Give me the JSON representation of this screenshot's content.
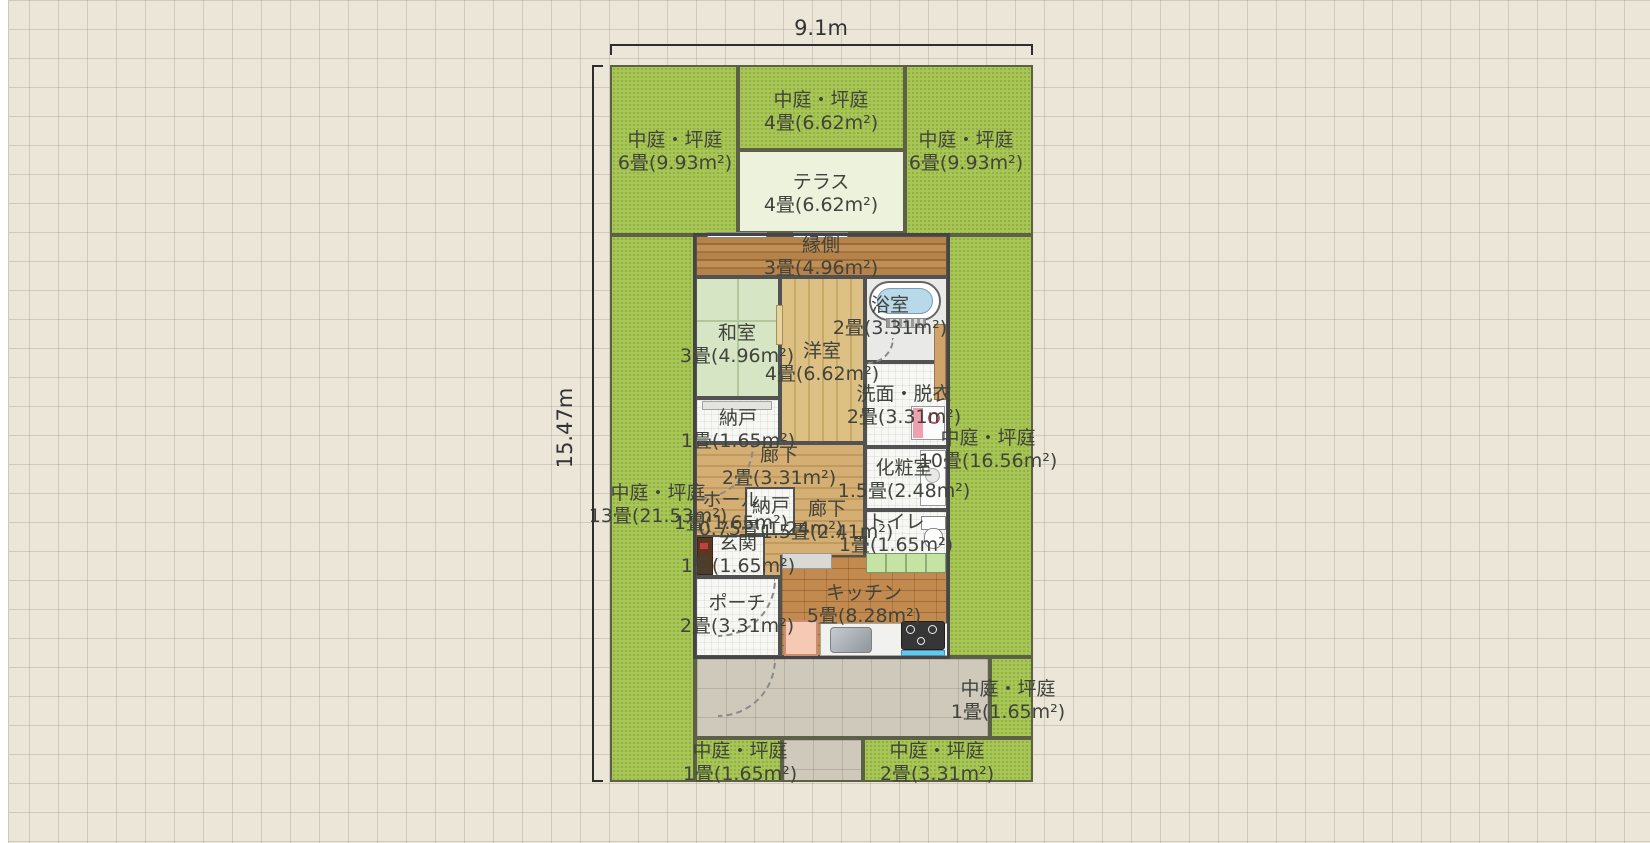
{
  "dimensions": {
    "width": "9.1m",
    "height": "15.47m"
  },
  "areas": {
    "g_top_left": {
      "name": "中庭・坪庭",
      "size": "6畳(9.93m²)"
    },
    "g_top_mid": {
      "name": "中庭・坪庭",
      "size": "4畳(6.62m²)"
    },
    "terrace": {
      "name": "テラス",
      "size": "4畳(6.62m²)"
    },
    "g_top_right": {
      "name": "中庭・坪庭",
      "size": "6畳(9.93m²)"
    },
    "g_left": {
      "name": "中庭・坪庭",
      "size": "13畳(21.53m²)"
    },
    "g_right": {
      "name": "中庭・坪庭",
      "size": "10畳(16.56m²)"
    },
    "g_right_small": {
      "name": "中庭・坪庭",
      "size": "1畳(1.65m²)"
    },
    "g_bottom_left": {
      "name": "中庭・坪庭",
      "size": "1畳(1.65m²)"
    },
    "g_bottom_right": {
      "name": "中庭・坪庭",
      "size": "2畳(3.31m²)"
    },
    "engawa": {
      "name": "縁側",
      "size": "3畳(4.96m²)"
    },
    "washitsu": {
      "name": "和室",
      "size": "3畳(4.96m²)"
    },
    "youshitsu": {
      "name": "洋室",
      "size": "4畳(6.62m²)"
    },
    "bathroom": {
      "name": "浴室",
      "size": "2畳(3.31m²)"
    },
    "senmen": {
      "name": "洗面・脱衣",
      "size": "2畳(3.31m²)"
    },
    "nando1": {
      "name": "納戸",
      "size": "1畳(1.65m²)"
    },
    "rouka1": {
      "name": "廊下",
      "size": "2畳(3.31m²)"
    },
    "keshoushitsu": {
      "name": "化粧室",
      "size": "1.5畳(2.48m²)"
    },
    "hall": {
      "name": "ホール",
      "size": "1畳(1.65m²)"
    },
    "nando2": {
      "name": "納戸",
      "size": "0.75畳(1.24m²)"
    },
    "rouka2": {
      "name": "廊下",
      "size": "1.5畳(2.41m²)"
    },
    "genkan": {
      "name": "玄関",
      "size": "1畳(1.65m²)"
    },
    "toilet": {
      "name": "トイレ",
      "size": "1畳(1.65m²)"
    },
    "porch": {
      "name": "ポーチ",
      "size": "2畳(3.31m²)"
    },
    "kitchen": {
      "name": "キッチン",
      "size": "5畳(8.28m²)"
    }
  }
}
